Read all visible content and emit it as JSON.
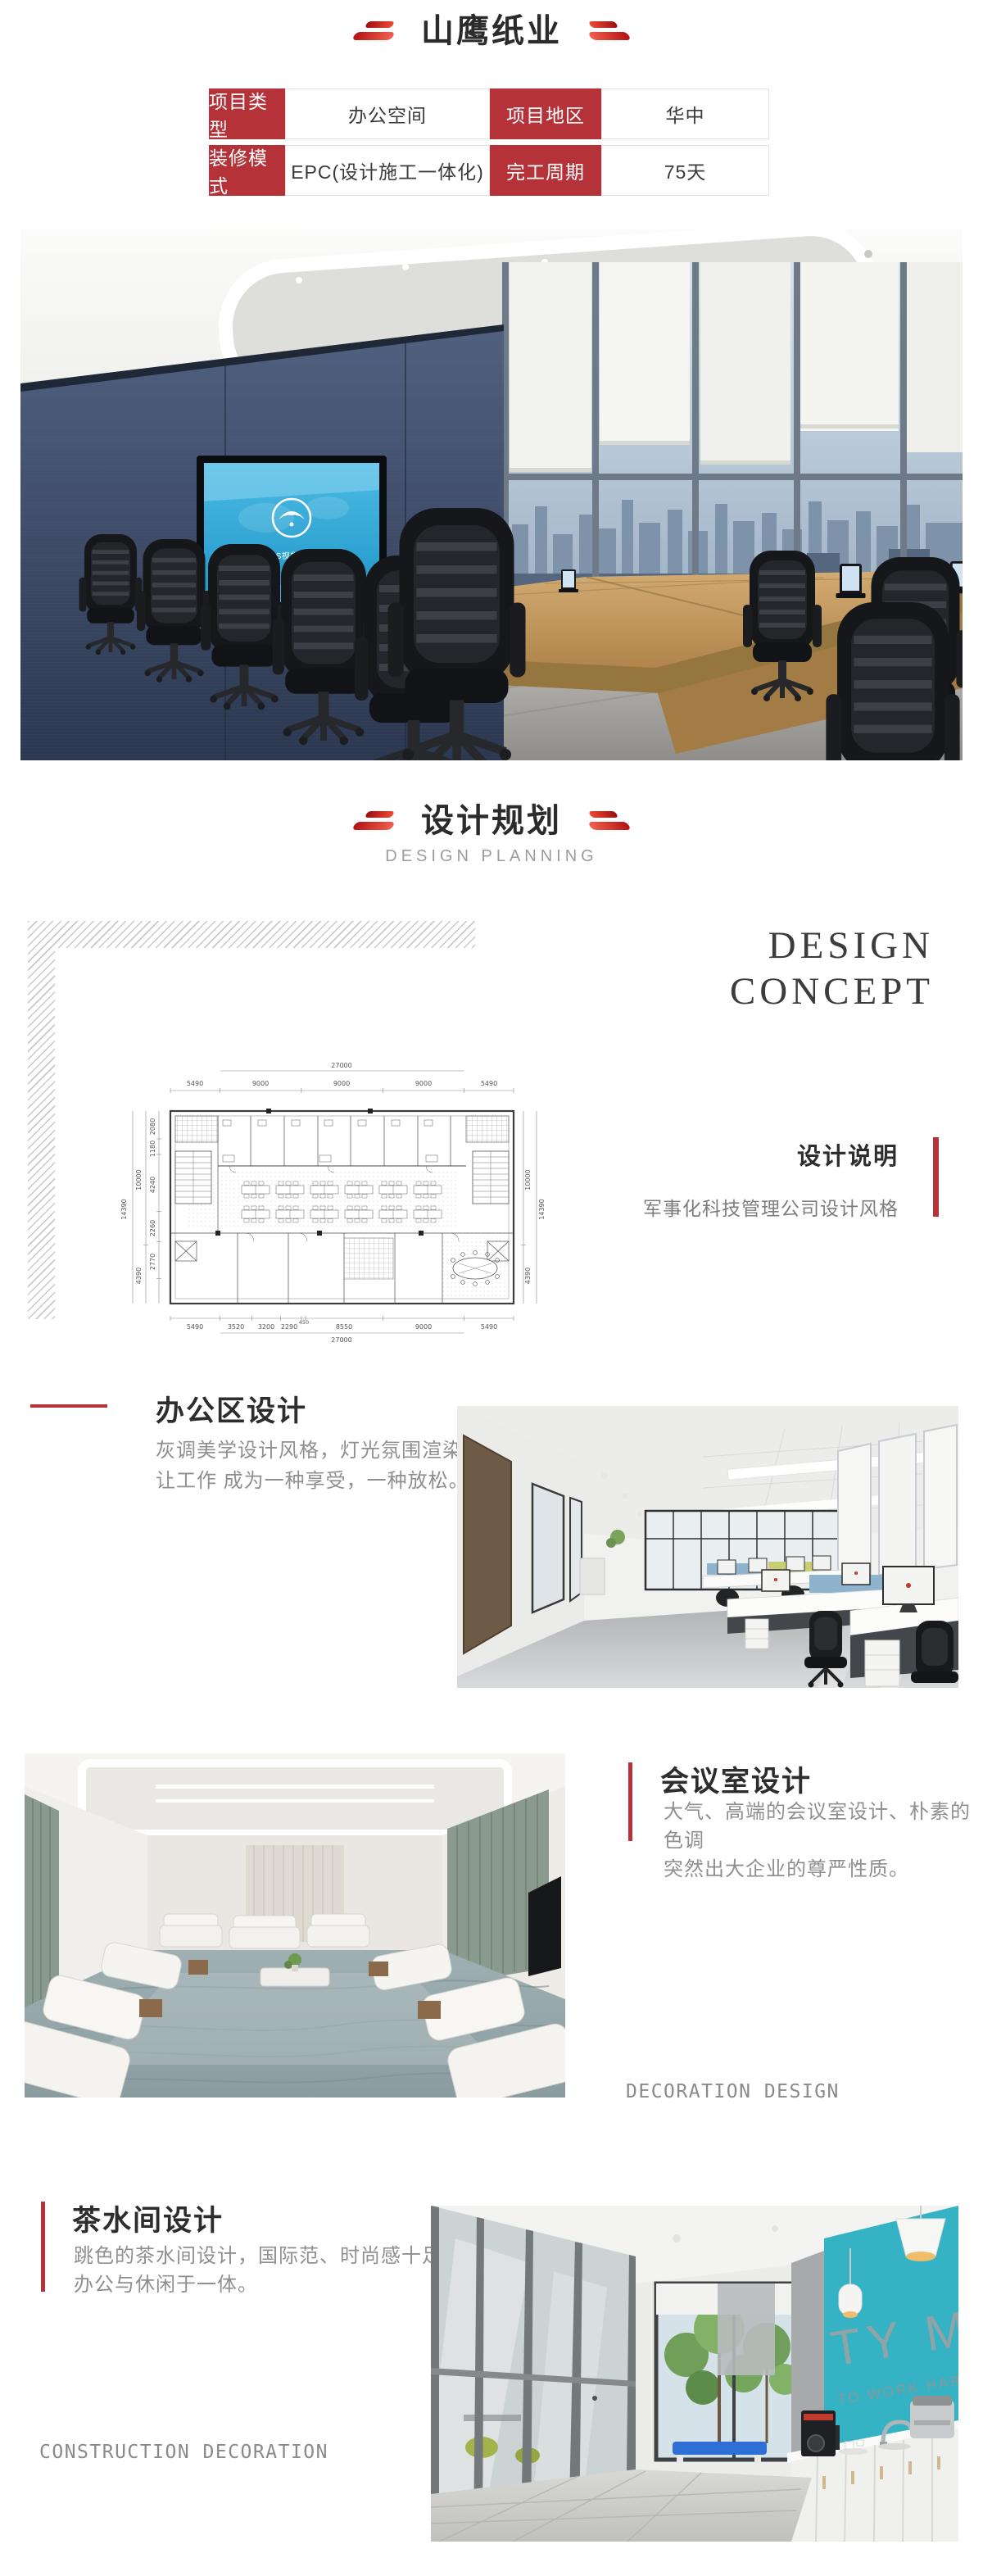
{
  "colors": {
    "accent_red": "#b43238",
    "bright_red": "#ef4a38",
    "text_dark": "#2b2b2b",
    "text_gray": "#8f8f8f",
    "screen_blue": "#2fa9d8",
    "teal_wall": "#35b3c4"
  },
  "header": {
    "title": "山鹰纸业"
  },
  "info_table": {
    "rows": [
      {
        "label1": "项目类型",
        "value1": "办公空间",
        "label2": "项目地区",
        "value2": "华中"
      },
      {
        "label1": "装修模式",
        "value1": "EPC(设计施工一体化)",
        "label2": "完工周期",
        "value2": "75天"
      }
    ]
  },
  "hero": {
    "screen_text": "山鹰纸业VIS视觉形象识别系统"
  },
  "section_planning": {
    "title": "设计规划",
    "subtitle": "DESIGN PLANNING"
  },
  "concept": {
    "heading_line1": "DESIGN",
    "heading_line2": "CONCEPT",
    "label": "设计说明",
    "description": "军事化科技管理公司设计风格"
  },
  "floor_plan": {
    "dim_top_total": "27000",
    "dims_top": [
      "5490",
      "9000",
      "9000",
      "9000",
      "5490"
    ],
    "dims_bottom": [
      "5490",
      "3520",
      "3200",
      "2290",
      "450",
      "8550",
      "9000",
      "5490"
    ],
    "dim_bottom_total": "27000",
    "dims_left_outer": "14390",
    "dims_left_mid": [
      "10000",
      "4390"
    ],
    "dims_left_inner": [
      "2080",
      "1180",
      "4240",
      "2260",
      "2770"
    ],
    "dims_right_inner": [
      "10000",
      "4390"
    ],
    "dims_right_outer": "14390"
  },
  "section_office": {
    "title": "办公区设计",
    "line1": "灰调美学设计风格，灯光氛围渲染，",
    "line2": "让工作 成为一种享受，一种放松。"
  },
  "section_meeting": {
    "title": "会议室设计",
    "line1": "大气、高端的会议室设计、朴素的色调",
    "line2": "突然出大企业的尊严性质。",
    "watermark": "DECORATION DESIGN"
  },
  "section_tea": {
    "title": "茶水间设计",
    "line1": "跳色的茶水间设计，国际范、时尚感十足",
    "line2": "办公与休闲于一体。",
    "watermark": "CONSTRUCTION DECORATION",
    "wall_word": "TY ME",
    "wall_sub": "TO WORK HARD"
  }
}
